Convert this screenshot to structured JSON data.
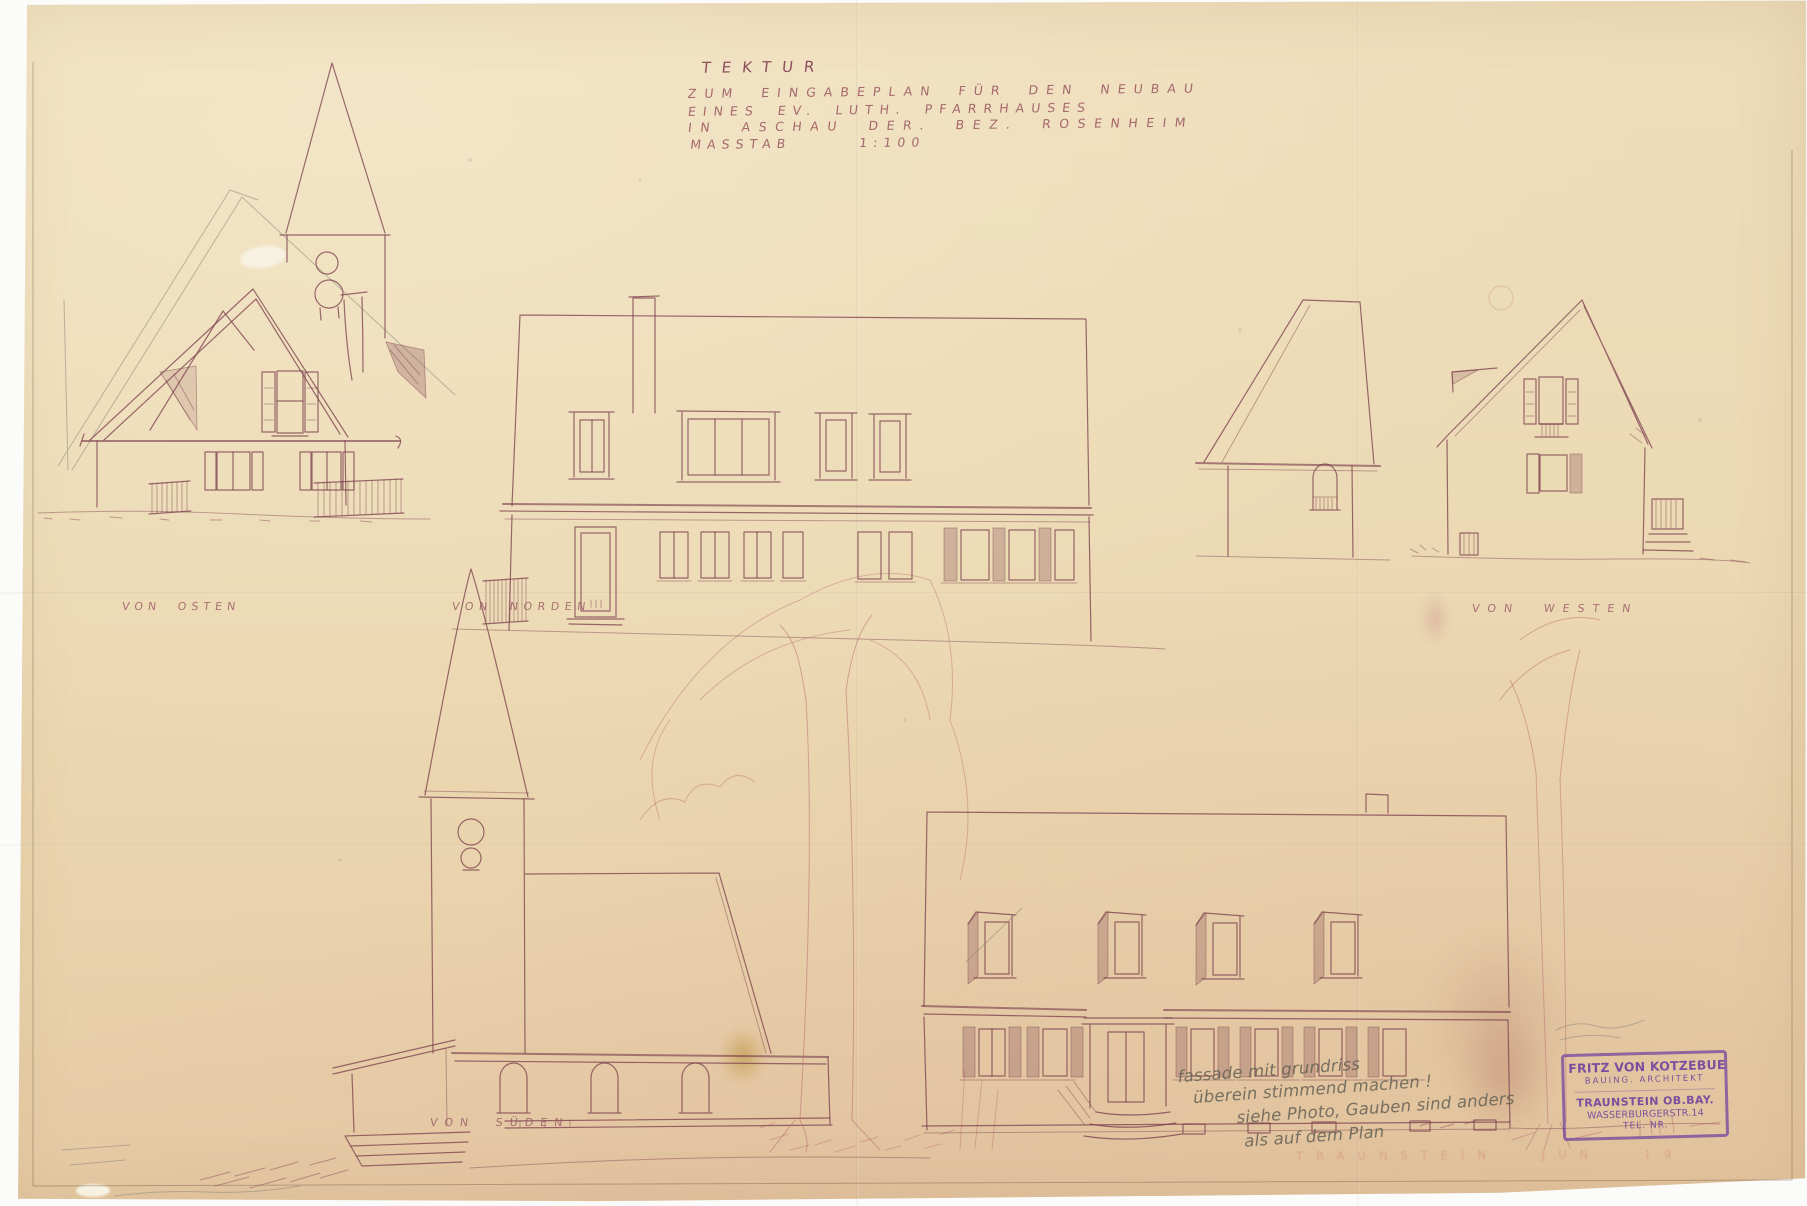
{
  "title_block": {
    "line1": "TEKTUR",
    "line2": "ZUM EINGABEPLAN FÜR DEN NEUBAU",
    "line3": "EINES EV. LUTH. PFARRHAUSES",
    "line4": "IN ASCHAU DER. BEZ. ROSENHEIM",
    "line5": "MASSTAB 1:100"
  },
  "view_labels": {
    "east": "VON OSTEN",
    "north": "VON NORDEN",
    "west": "VON WESTEN",
    "south": "VON SÜDEN"
  },
  "handwritten_note": {
    "line1": "fassade mit grundriss",
    "line2": "überein stimmend machen !",
    "line3": "siehe Photo, Gauben sind anders",
    "line4": "als auf dem Plan"
  },
  "stamp": {
    "name": "FRITZ VON KOTZEBUE",
    "title": "BAUING. ARCHITEKT",
    "city": "TRAUNSTEIN OB.BAY.",
    "street": "WASSERBURGERSTR.14",
    "phone": "TEL. NR."
  },
  "faint_footer": "TRAUNSTEIN  JUN  19",
  "colors": {
    "paper": "#ecd9b4",
    "ink": "#7e4350",
    "pencil": "#8e887c",
    "stamp_purple": "#6f3fa6",
    "faint_red": "#c84646"
  }
}
